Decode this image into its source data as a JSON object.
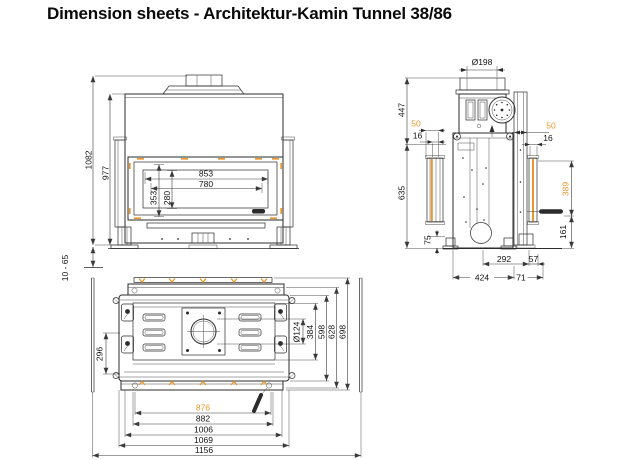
{
  "title": "Dimension sheets - Architektur-Kamin Tunnel 38/86",
  "colors": {
    "accent_orange": "#e8962d",
    "line": "#2b2b2b"
  },
  "front_view": {
    "overall_height": "1082",
    "body_height": "977",
    "glass_width": "853",
    "opening_width": "780",
    "glass_height": "353",
    "opening_height": "280",
    "foot_adjustment": "10 - 65"
  },
  "side_view": {
    "flue_diameter": "Ø198",
    "upper_height": "447",
    "front_gap": "50",
    "front_inset": "16",
    "lower_height": "635",
    "rear_gap": "50",
    "rear_inset": "16",
    "handle_height": "389",
    "base_height": "161",
    "foot_height": "75",
    "flue_center_depth": "292",
    "rear_offset": "57",
    "body_depth": "424",
    "rear_overhang": "71"
  },
  "plan_view": {
    "latch_spacing": "296",
    "flue_diameter": "Ø124",
    "inner_depth": "384",
    "body_depth": "598",
    "frame_depth": "628",
    "overall_depth": "698",
    "glass_width": "876",
    "door_width": "882",
    "body_width": "1006",
    "frame_width": "1069",
    "overall_width": "1156"
  }
}
